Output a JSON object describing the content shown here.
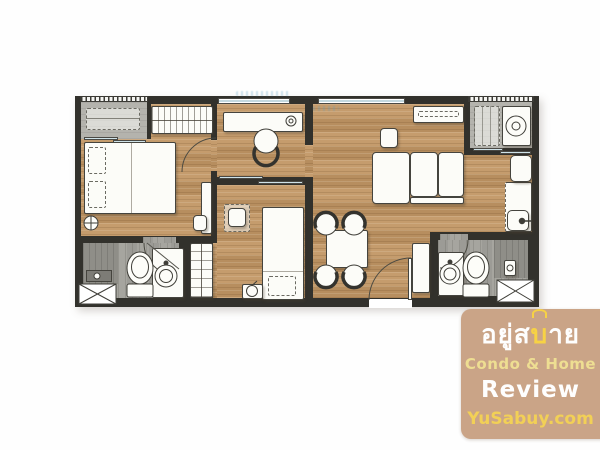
{
  "watermark": {
    "brand_prefix": "อยู่ส",
    "brand_highlight": "บ",
    "brand_suffix": "าย",
    "tagline": "Condo & Home",
    "review": "Review",
    "site": "YuSabuy.com"
  },
  "colors": {
    "badge_bg": "#c9a284",
    "badge_yellow": "#f2cf51",
    "badge_pale_yellow": "#eedd8f",
    "badge_white": "#ffffff",
    "wall": "#32312c",
    "wood_floor": "#c29765",
    "bathroom_floor": "#a6a59f",
    "balcony_floor": "#b4b3ad",
    "furniture": "#fcfcf8",
    "window_glass": "#c3d8de"
  }
}
